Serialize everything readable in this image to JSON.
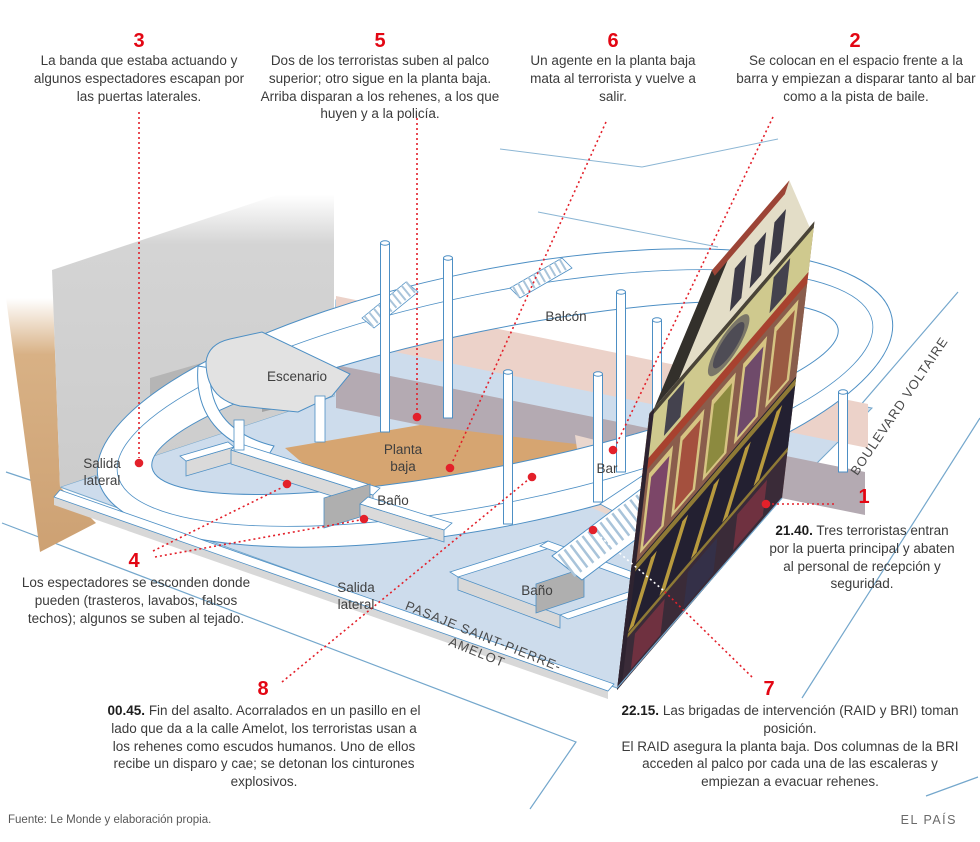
{
  "figure": {
    "source": "Fuente: Le Monde y elaboración propia.",
    "brand": "EL PAÍS"
  },
  "colors": {
    "accent_red": "#e30613",
    "dot_red": "#e3202a",
    "line_blue": "#4d8fc4",
    "street_blue": "#74a7cc",
    "floor_blue": "#cddcec",
    "floor_tan": "#d6a571",
    "balcony_pink": "#ecd2c9",
    "wall_gray": "#d0d0d0",
    "wall_tan": "#d2a878"
  },
  "callouts": {
    "c1": {
      "number": "1",
      "time": "21.40.",
      "text": "Tres terroristas entran por la puerta principal y abaten al personal de recepción y seguridad."
    },
    "c2": {
      "number": "2",
      "text": "Se colocan en el espacio frente a la barra y empiezan a disparar tanto al bar como a la pista de baile."
    },
    "c3": {
      "number": "3",
      "text": "La banda que estaba actuando y algunos espectadores escapan por las puertas laterales."
    },
    "c4": {
      "number": "4",
      "text": "Los espectadores se esconden donde pueden (trasteros, lavabos, falsos techos); algunos se suben al tejado."
    },
    "c5": {
      "number": "5",
      "text": "Dos de los terroristas suben al palco superior; otro sigue en la planta baja. Arriba disparan a los rehenes, a los que huyen y a la policía."
    },
    "c6": {
      "number": "6",
      "text": "Un agente en la planta baja mata al terrorista y vuelve a salir."
    },
    "c7": {
      "number": "7",
      "time": "22.15.",
      "text": "Las brigadas de intervención (RAID y BRI) toman posición.",
      "text2": "El RAID asegura la planta baja. Dos columnas de la BRI acceden al palco por cada una de las escaleras y empiezan a evacuar rehenes."
    },
    "c8": {
      "number": "8",
      "time": "00.45.",
      "text": "Fin del asalto. Acorralados en un pasillo en el lado que da a la calle Amelot, los terroristas usan a los rehenes como escudos humanos. Uno de ellos recibe un disparo y cae; se detonan los cinturones explosivos."
    }
  },
  "labels": {
    "balcon": "Balcón",
    "escenario": "Escenario",
    "planta_baja": "Planta baja",
    "bar": "Bar",
    "salida_lateral": "Salida lateral",
    "bano": "Baño",
    "pasaje": "PASAJE SAINT-PIERRE-AMELOT",
    "boulevard": "BOULEVARD VOLTAIRE"
  }
}
